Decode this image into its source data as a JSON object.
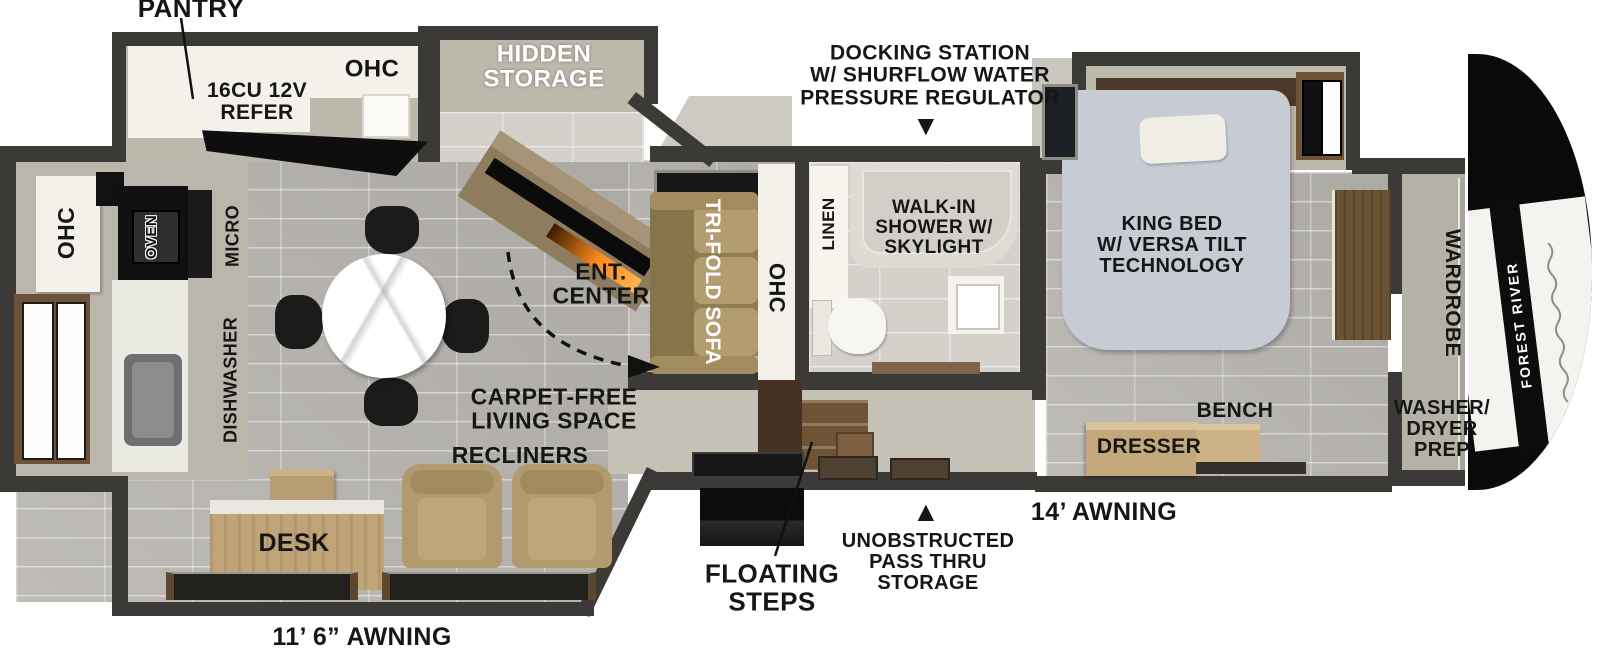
{
  "labels": {
    "pantry": "PANTRY",
    "slide_ohc": "OHC",
    "refer": "16CU 12V\nREFER",
    "hidden_storage": "HIDDEN\nSTORAGE",
    "docking": "DOCKING STATION\nW/ SHURFLOW WATER\nPRESSURE REGULATOR",
    "kitchen_ohc": "OHC",
    "oven": "OVEN",
    "micro": "MICRO",
    "dishwasher": "DISHWASHER",
    "ent_center": "ENT.\nCENTER",
    "trifold_sofa": "TRI-FOLD SOFA",
    "sofa_ohc": "OHC",
    "linen": "LINEN",
    "shower": "WALK-IN\nSHOWER W/\nSKYLIGHT",
    "king_bed": "KING BED\nW/ VERSA TILT\nTECHNOLOGY",
    "wardrobe": "WARDROBE",
    "washer_dryer": "WASHER/\nDRYER\nPREP",
    "bench": "BENCH",
    "dresser": "DRESSER",
    "carpet_free": "CARPET-FREE\nLIVING SPACE",
    "recliners": "RECLINERS",
    "desk": "DESK",
    "floating_steps": "FLOATING\nSTEPS",
    "pass_thru": "UNOBSTRUCTED\nPASS THRU\nSTORAGE",
    "awning_14": "14’ AWNING",
    "awning_11_6": "11’ 6” AWNING",
    "brand": "FOREST RIVER"
  },
  "icons": {
    "down_arrow": "▼",
    "up_arrow": "▲"
  },
  "colors": {
    "wall": "#3b3a37",
    "floor_tile": "#b7b4af",
    "slide_floor": "#bcb8ac",
    "counter_white": "#f3f1e9",
    "wood": "#c2a87a",
    "sofa_tan": "#b19a6d",
    "bed_gray": "#c7cbd4",
    "cap_black": "#0a0a0a",
    "fireplace_glow": "#ff8c1e",
    "label_text": "#161616"
  }
}
